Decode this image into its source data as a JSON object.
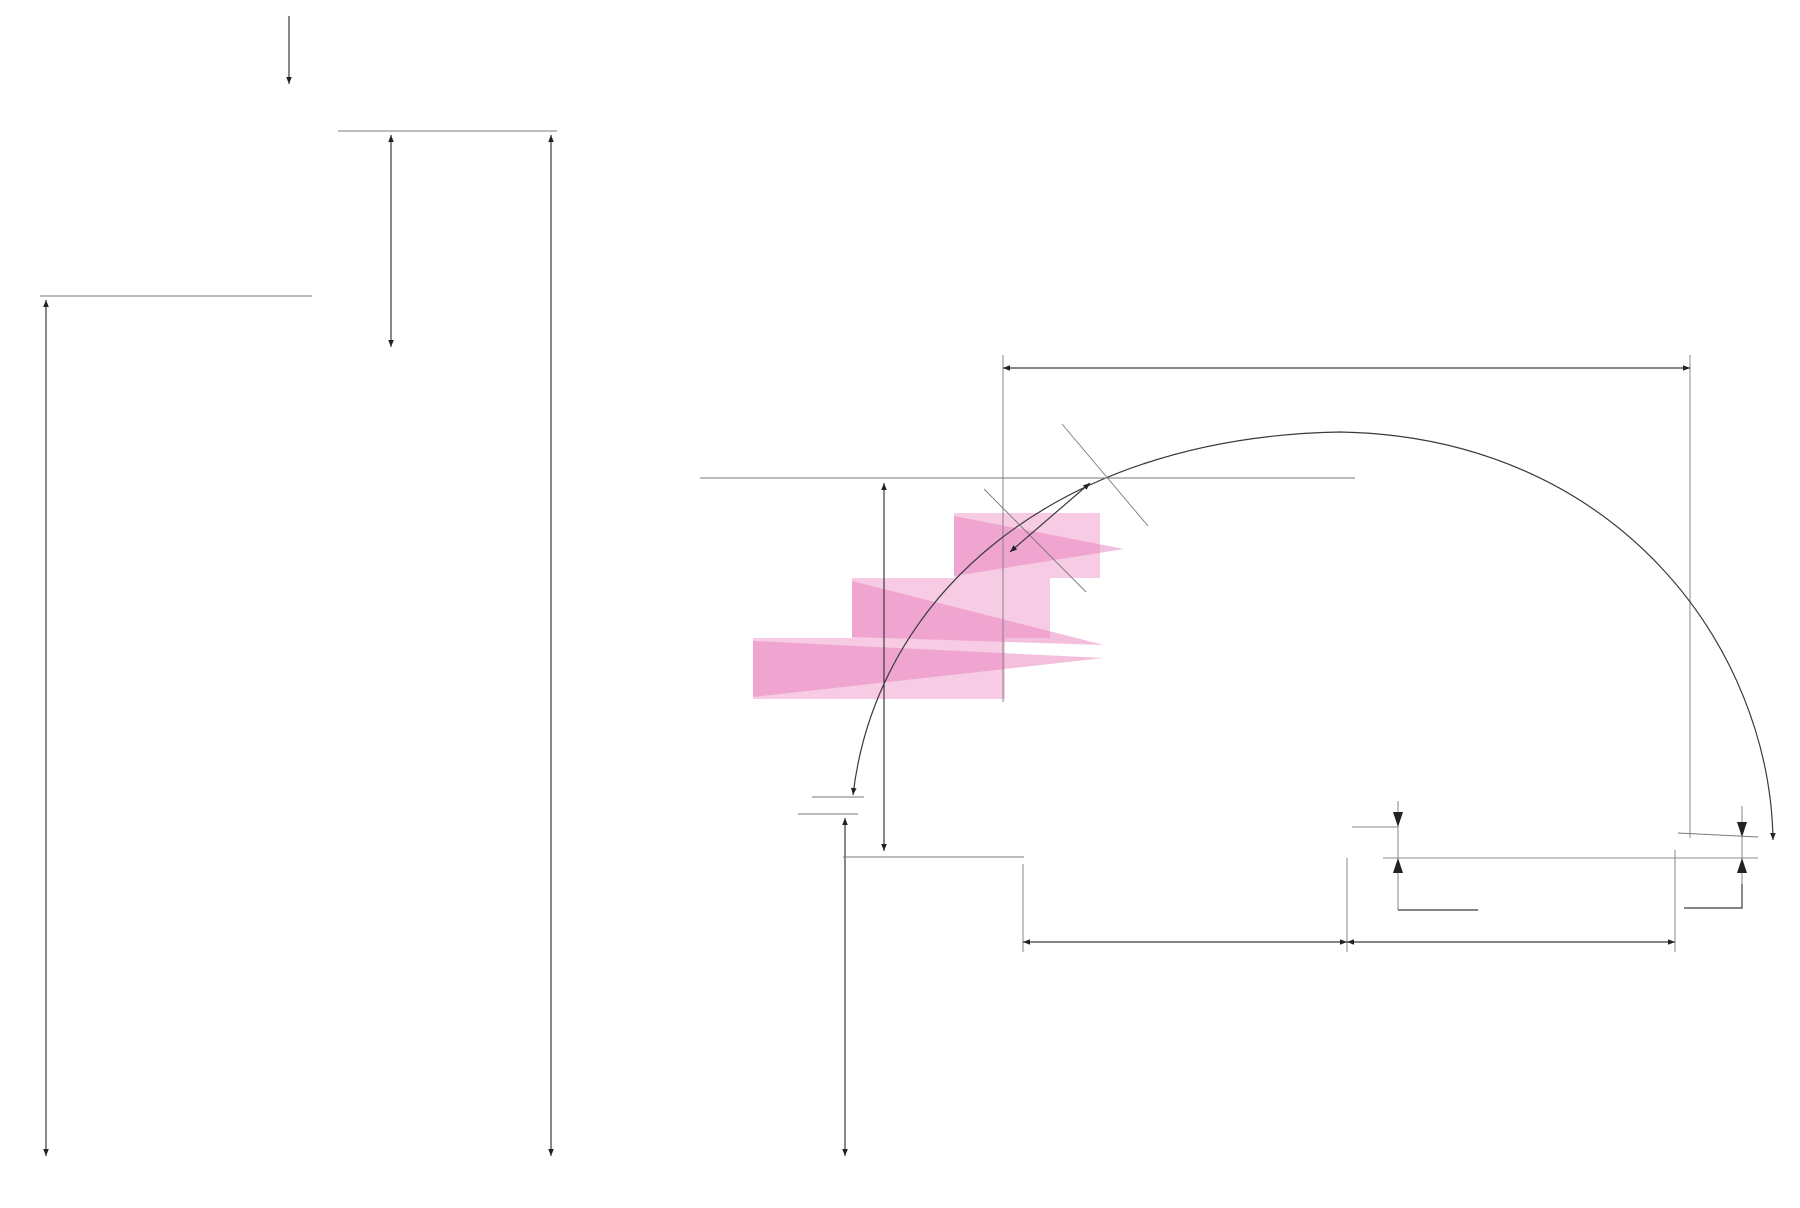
{
  "section_marker": {
    "label": "A"
  },
  "side_view": {
    "rail_height": "948,5",
    "overall_height": "3938,5",
    "structure_height": "3185",
    "riser": {
      "label": "230",
      "count": 14
    }
  },
  "front_view": {
    "lower_height": "1378,5"
  },
  "plan_view": {
    "overall_width": "1203",
    "angle": "177°",
    "step_width": "144",
    "depth": "659",
    "hub_offset": "55",
    "left_span": "567",
    "right_span": "568",
    "end_rise": "28",
    "tread_count": 13,
    "tread_numbers": [
      {
        "index": 1,
        "label": "1"
      },
      {
        "index": 2,
        "label": "2"
      },
      {
        "index": 3,
        "label": "3"
      },
      {
        "index": 13,
        "label": "13"
      }
    ]
  },
  "colors": {
    "wood": "#bd9166",
    "wood_alt": "#b3875c",
    "wood_edge": "#6f4a2d",
    "metal": "#a8a8aa",
    "metal_dark": "#6e6e71",
    "highlight_pink": "#f2a8d2",
    "highlight_pink_dark": "#e87fba",
    "dim_line": "#3a3a3c",
    "text": "#1b1b1d"
  }
}
